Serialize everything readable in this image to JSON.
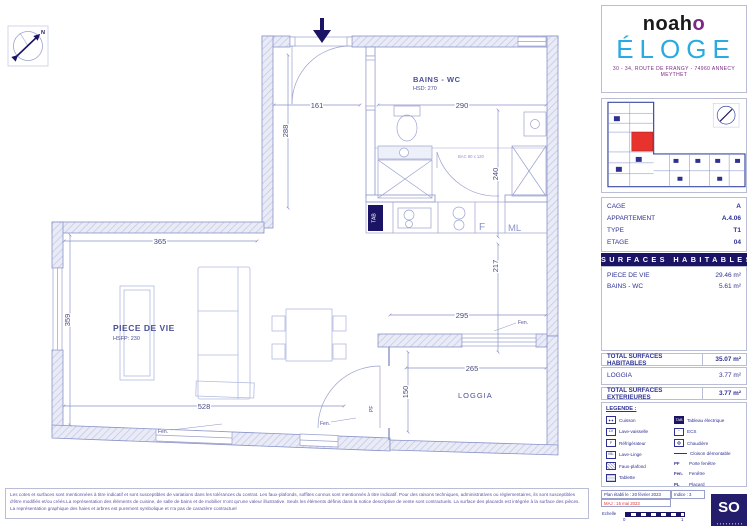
{
  "brand": {
    "logo_text": "noah",
    "logo_o": "o",
    "project": "ÉLOGE",
    "address": "30 - 34, ROUTE DE FRANGY - 74960 ANNECY MEYTHET"
  },
  "info": {
    "rows": [
      {
        "label": "CAGE",
        "value": "A"
      },
      {
        "label": "APPARTEMENT",
        "value": "A.4.06"
      },
      {
        "label": "TYPE",
        "value": "T1"
      },
      {
        "label": "ETAGE",
        "value": "04"
      }
    ]
  },
  "surfaces": {
    "header": "SURFACES HABITABLES",
    "rows": [
      {
        "label": "PIECE DE VIE",
        "value": "29.46 m²"
      },
      {
        "label": "BAINS - WC",
        "value": "5.61 m²"
      }
    ],
    "total_label": "TOTAL SURFACES HABITABLES",
    "total_value": "35.07 m²",
    "exterior_rows": [
      {
        "label": "LOGGIA",
        "value": "3.77 m²"
      }
    ],
    "exterior_total_label": "TOTAL SURFACES EXTERIEURES",
    "exterior_total_value": "3.77 m²"
  },
  "legend": {
    "title": "LEGENDE :",
    "left": [
      {
        "icon": "",
        "label": "Cuisson"
      },
      {
        "icon": "LV",
        "label": "Lave-vaisselle"
      },
      {
        "icon": "F",
        "label": "Réfrigérateur"
      },
      {
        "icon": "ML",
        "label": "Lave-Linge"
      },
      {
        "icon": "",
        "label": "Faux-plafond"
      },
      {
        "icon": "",
        "label": "Tablette"
      }
    ],
    "right": [
      {
        "icon": "TAB",
        "label": "Tableau électrique"
      },
      {
        "icon": "~",
        "label": "ECS"
      },
      {
        "icon": "",
        "label": "Chaudière"
      },
      {
        "icon": "",
        "label": "Cloison démontable"
      },
      {
        "icon": "PF",
        "label": "Porte fenêtre"
      },
      {
        "icon": "Fen.",
        "label": "Fenêtre"
      },
      {
        "icon": "PL",
        "label": "Placard"
      }
    ]
  },
  "footer": {
    "plan_date": "Plan établi le : 20 février 2023",
    "indice": "Indice : 3",
    "maj": "MAJ : 15 mai 2023",
    "echelle_label": "Echelle",
    "scale_start": "0",
    "scale_end": "1",
    "logo": "SO"
  },
  "plan": {
    "north_label": "N",
    "rooms": {
      "bains_name": "BAINS - WC",
      "bains_height": "HSD: 270",
      "pdv_name": "PIECE DE VIE",
      "pdv_height": "HSFP: 230",
      "loggia_name": "LOGGIA"
    },
    "dims": {
      "d161": "161",
      "d290": "290",
      "d288": "288",
      "d240": "240",
      "d365": "365",
      "d217": "217",
      "d295": "295",
      "d359": "359",
      "d265": "265",
      "d528": "528",
      "d150": "150"
    },
    "labels": {
      "f": "F",
      "ml": "ML",
      "tab": "TAB",
      "pf": "PF",
      "fen1": "Fen.",
      "fen2": "Fen.",
      "fen3": "Fen.",
      "bac": "BAC 80 x 120"
    }
  },
  "disclaimer": {
    "line1": "Les cotes et surfaces sont mentionnées à titre indicatif et sont susceptibles de variations dans les tolérances du contrat. Les faux-plafonds, soffites connus sont mentionnés à titre indicatif. Pour des raisons techniques, administratives ou réglementaires, ils",
    "line2": "sont susceptibles d'être modifiés et/ou créés.La représentation des éléments de cuisine, de salle de bains et de mobilier n'ont qu'une valeur illustrative. Seuls les éléments définis dans la notice descriptive de vente sont contractuels. La surface des placards",
    "line3": "est intégrée à la surface des pièces. La représentation graphique des haies et arbres est purement symbolique et n'a pas de caractère contractuel"
  },
  "colors": {
    "navy": "#1b1464",
    "blue": "#29abe2",
    "purple": "#7b2982",
    "red": "#e8322e",
    "plan_line": "#8a93c8"
  }
}
